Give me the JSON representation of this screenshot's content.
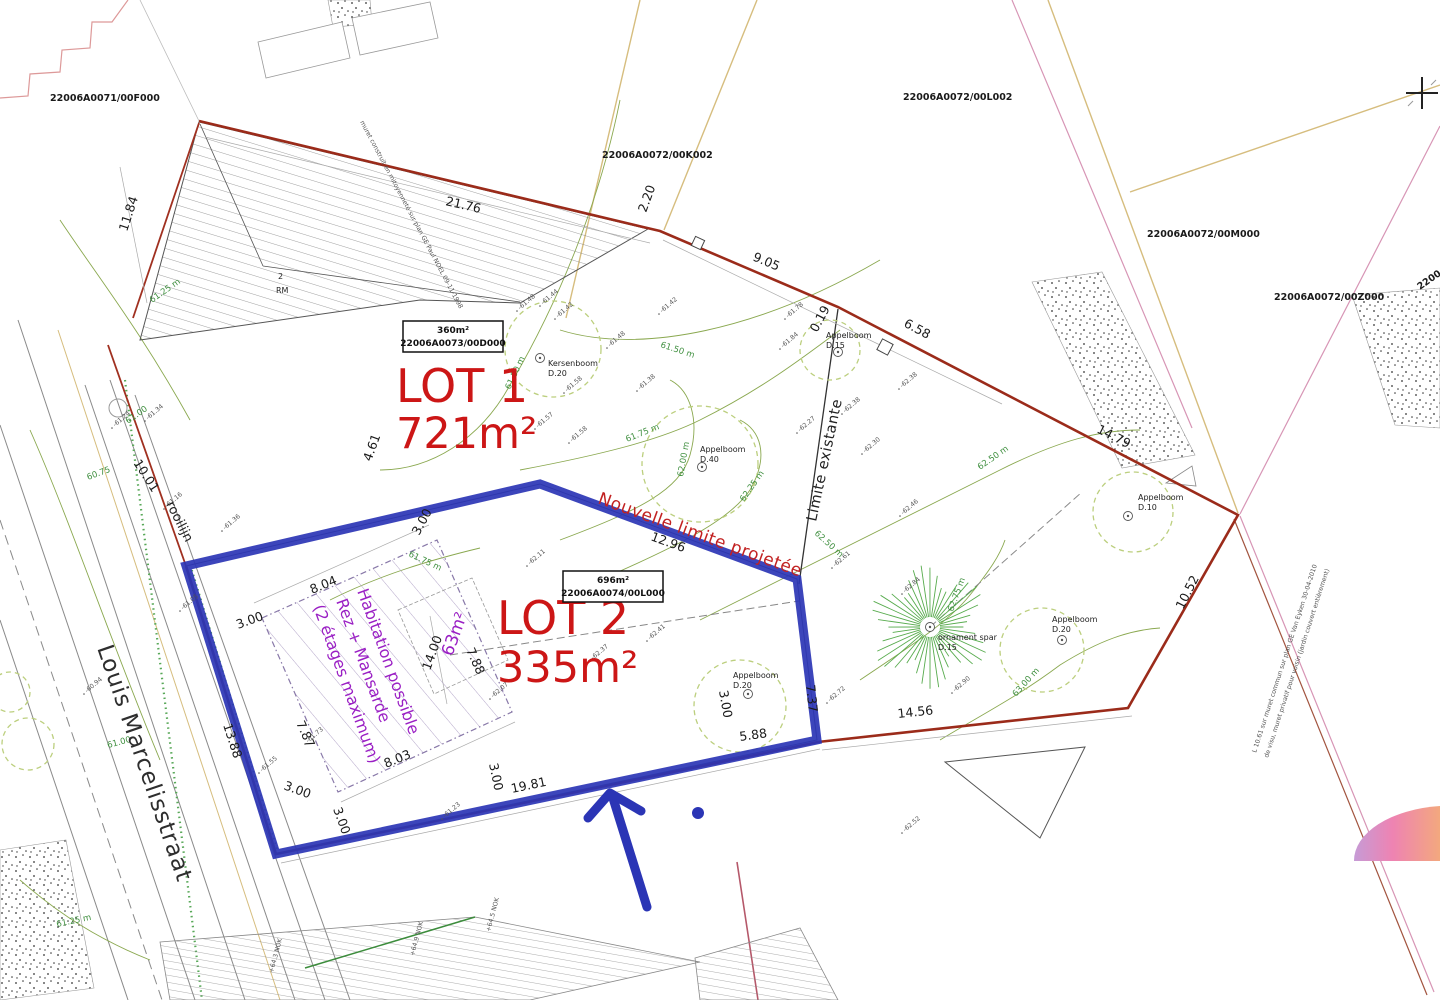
{
  "title": "Cadastral division plan - Louis Marcelisstraat",
  "colors": {
    "lot_outline_blue": "#2b35b5",
    "boundary_red": "#9b2b1a",
    "lot_text_red": "#cc1616",
    "habitation_purple": "#9a1fc4",
    "contour_green": "#3f8f3f",
    "crown_green": "#bccf7e",
    "spar_green": "#57ab4d",
    "cadastral_beige": "#d6bd7e",
    "cadastral_pink": "#d795b5",
    "street_grey": "#8a8a8a",
    "dome_gradient": [
      "#c69bd6",
      "#ee83b2",
      "#f3a87e"
    ]
  },
  "parcel_labels": [
    {
      "t": "22006A0071/00F000",
      "x": 50,
      "y": 101,
      "r": 0
    },
    {
      "t": "22006A0072/00K002",
      "x": 602,
      "y": 158,
      "r": 0
    },
    {
      "t": "22006A0072/00L002",
      "x": 903,
      "y": 100,
      "r": 0
    },
    {
      "t": "22006A0072/00M000",
      "x": 1147,
      "y": 237,
      "r": 0
    },
    {
      "t": "22006A0072/00Z000",
      "x": 1274,
      "y": 300,
      "r": 0
    },
    {
      "t": "2200",
      "x": 1420,
      "y": 290,
      "r": -35
    }
  ],
  "lots": [
    {
      "name": "LOT 1",
      "area": "721m²",
      "nx": 396,
      "ny": 402,
      "ax": 396,
      "ay": 448
    },
    {
      "name": "LOT 2",
      "area": "335m²",
      "nx": 497,
      "ny": 634,
      "ax": 497,
      "ay": 682
    }
  ],
  "parcel_boxes": [
    {
      "x": 403,
      "y": 321,
      "w": 100,
      "h": 31,
      "line1": "360m²",
      "line2": "22006A0073/00D000"
    },
    {
      "x": 563,
      "y": 571,
      "w": 100,
      "h": 31,
      "line1": "696m²",
      "line2": "22006A0074/00L000"
    }
  ],
  "measurements": [
    {
      "t": "21.76",
      "x": 445,
      "y": 205,
      "r": 13
    },
    {
      "t": "2.20",
      "x": 646,
      "y": 213,
      "r": -70
    },
    {
      "t": "9.05",
      "x": 752,
      "y": 260,
      "r": 23
    },
    {
      "t": "6.58",
      "x": 903,
      "y": 326,
      "r": 28
    },
    {
      "t": "0.19",
      "x": 817,
      "y": 333,
      "r": -62
    },
    {
      "t": "11.84",
      "x": 127,
      "y": 232,
      "r": -72
    },
    {
      "t": "14.79",
      "x": 1096,
      "y": 432,
      "r": 27
    },
    {
      "t": "10.52",
      "x": 1183,
      "y": 610,
      "r": -63
    },
    {
      "t": "12.96",
      "x": 650,
      "y": 540,
      "r": 20
    },
    {
      "t": "14.56",
      "x": 898,
      "y": 718,
      "r": -6
    },
    {
      "t": "5.88",
      "x": 740,
      "y": 741,
      "r": -8
    },
    {
      "t": "7.37",
      "x": 806,
      "y": 685,
      "r": 84
    },
    {
      "t": "19.81",
      "x": 512,
      "y": 793,
      "r": -12
    },
    {
      "t": "13.88",
      "x": 223,
      "y": 725,
      "r": 72
    },
    {
      "t": "10.01",
      "x": 133,
      "y": 463,
      "r": 57
    },
    {
      "t": "4.61",
      "x": 371,
      "y": 462,
      "r": -70
    },
    {
      "t": "8.04",
      "x": 312,
      "y": 594,
      "r": -22
    },
    {
      "t": "7.87",
      "x": 296,
      "y": 723,
      "r": 66
    },
    {
      "t": "7.88",
      "x": 466,
      "y": 650,
      "r": 66
    },
    {
      "t": "8.03",
      "x": 386,
      "y": 768,
      "r": -22
    },
    {
      "t": "14.00",
      "x": 430,
      "y": 671,
      "r": -70
    },
    {
      "t": "3.00",
      "x": 419,
      "y": 536,
      "r": -62
    },
    {
      "t": "3.00",
      "x": 238,
      "y": 629,
      "r": -20
    },
    {
      "t": "3.00",
      "x": 283,
      "y": 789,
      "r": 20
    },
    {
      "t": "3.00",
      "x": 333,
      "y": 809,
      "r": 70
    },
    {
      "t": "3.00",
      "x": 489,
      "y": 764,
      "r": 78
    },
    {
      "t": "3.00",
      "x": 719,
      "y": 691,
      "r": 80
    }
  ],
  "contour_labels": [
    {
      "t": "61.50 m",
      "x": 510,
      "y": 390,
      "r": -65
    },
    {
      "t": "61.50 m",
      "x": 660,
      "y": 347,
      "r": 18
    },
    {
      "t": "61.75 m",
      "x": 627,
      "y": 442,
      "r": -22
    },
    {
      "t": "62.00 m",
      "x": 683,
      "y": 477,
      "r": -80
    },
    {
      "t": "62.25 m",
      "x": 744,
      "y": 502,
      "r": -55
    },
    {
      "t": "62.50 m",
      "x": 980,
      "y": 470,
      "r": -35
    },
    {
      "t": "62.50 m",
      "x": 814,
      "y": 534,
      "r": 42
    },
    {
      "t": "62.75 m",
      "x": 953,
      "y": 612,
      "r": -70
    },
    {
      "t": "63.00 m",
      "x": 1016,
      "y": 697,
      "r": -48
    },
    {
      "t": "61.25 m",
      "x": 152,
      "y": 303,
      "r": -35
    },
    {
      "t": "61.00",
      "x": 128,
      "y": 424,
      "r": -35
    },
    {
      "t": "61.00",
      "x": 108,
      "y": 748,
      "r": -15
    },
    {
      "t": "61.25 m",
      "x": 57,
      "y": 927,
      "r": -12
    },
    {
      "t": "60.75",
      "x": 88,
      "y": 480,
      "r": -20
    },
    {
      "t": "61.75 m",
      "x": 408,
      "y": 556,
      "r": 25
    }
  ],
  "spot_elevations": [
    {
      "t": "-61.48",
      "x": 520,
      "y": 310
    },
    {
      "t": "-61.44",
      "x": 543,
      "y": 305
    },
    {
      "t": "-61.42",
      "x": 558,
      "y": 318
    },
    {
      "t": "-61.48",
      "x": 610,
      "y": 347
    },
    {
      "t": "-61.42",
      "x": 662,
      "y": 313
    },
    {
      "t": "-61.58",
      "x": 567,
      "y": 392
    },
    {
      "t": "-61.57",
      "x": 538,
      "y": 428
    },
    {
      "t": "-61.58",
      "x": 572,
      "y": 442
    },
    {
      "t": "-61.38",
      "x": 640,
      "y": 390
    },
    {
      "t": "-61.78",
      "x": 788,
      "y": 318
    },
    {
      "t": "-61.84",
      "x": 783,
      "y": 348
    },
    {
      "t": "-62.38",
      "x": 902,
      "y": 388
    },
    {
      "t": "-62.38",
      "x": 845,
      "y": 413
    },
    {
      "t": "-62.27",
      "x": 800,
      "y": 432
    },
    {
      "t": "-62.30",
      "x": 865,
      "y": 453
    },
    {
      "t": "-62.46",
      "x": 903,
      "y": 515
    },
    {
      "t": "-62.61",
      "x": 835,
      "y": 567
    },
    {
      "t": "-62.84",
      "x": 905,
      "y": 593
    },
    {
      "t": "-62.90",
      "x": 955,
      "y": 692
    },
    {
      "t": "-62.72",
      "x": 830,
      "y": 702
    },
    {
      "t": "-62.11",
      "x": 530,
      "y": 565
    },
    {
      "t": "-62.41",
      "x": 650,
      "y": 640
    },
    {
      "t": "-62.37",
      "x": 593,
      "y": 660
    },
    {
      "t": "-61.16",
      "x": 167,
      "y": 508
    },
    {
      "t": "-61.36",
      "x": 225,
      "y": 530
    },
    {
      "t": "-61.05",
      "x": 183,
      "y": 610
    },
    {
      "t": "-60.94",
      "x": 87,
      "y": 693
    },
    {
      "t": "-61.34",
      "x": 148,
      "y": 420
    },
    {
      "t": "-61.24",
      "x": 115,
      "y": 427
    },
    {
      "t": "-61.55",
      "x": 262,
      "y": 772
    },
    {
      "t": "-61.73",
      "x": 308,
      "y": 743
    },
    {
      "t": "-62.07",
      "x": 493,
      "y": 698
    },
    {
      "t": "-62.52",
      "x": 905,
      "y": 832
    },
    {
      "t": "-61.23",
      "x": 445,
      "y": 818
    }
  ],
  "texts": [
    {
      "t": "Louis Marcelisstraat",
      "x": 97,
      "y": 648,
      "r": 71,
      "cls": "street",
      "name": "street-name"
    },
    {
      "t": "rooilijn",
      "x": 166,
      "y": 504,
      "r": 63,
      "cls": "small-black",
      "name": "rooilijn-label"
    },
    {
      "t": "Limite existante",
      "x": 816,
      "y": 522,
      "r": -78,
      "cls": "limite",
      "name": "existing-limit-label"
    },
    {
      "t": "Nouvelle limite projetée",
      "x": 597,
      "y": 503,
      "r": 20,
      "cls": "nouvelle",
      "name": "new-limit-label"
    },
    {
      "t": "Habitation possible",
      "x": 357,
      "y": 591,
      "r": 70,
      "cls": "purple",
      "name": "habitation-note-line1"
    },
    {
      "t": "Rez + Mansarde",
      "x": 336,
      "y": 601,
      "r": 70,
      "cls": "purple",
      "name": "habitation-note-line2"
    },
    {
      "t": "(2 étages maximum)",
      "x": 313,
      "y": 607,
      "r": 70,
      "cls": "purple",
      "name": "habitation-note-line3"
    },
    {
      "t": "63m²",
      "x": 452,
      "y": 657,
      "r": -70,
      "cls": "purple63",
      "name": "footprint-area-label"
    },
    {
      "t": "RM",
      "x": 276,
      "y": 293,
      "r": 0,
      "cls": "tinyb",
      "name": "building-label-rm"
    },
    {
      "t": "2",
      "x": 278,
      "y": 279,
      "r": 0,
      "cls": "tinyb",
      "name": "building-label-2"
    },
    {
      "t": "muret construit en mitoyenneté sur plan GE Paul NOEL 09-11-1998",
      "x": 360,
      "y": 122,
      "r": 62,
      "cls": "tiny",
      "name": "wall-annotation-left"
    },
    {
      "t": "L 10.61 sur muret commun sur plan GE Van Eyken 30-04-2010",
      "x": 1256,
      "y": 753,
      "r": -72,
      "cls": "tiny",
      "name": "wall-annotation-right-1"
    },
    {
      "t": "de visu, muret privatif pour voisin (jardin couvert entièrement)",
      "x": 1268,
      "y": 758,
      "r": -72,
      "cls": "tiny",
      "name": "wall-annotation-right-2"
    },
    {
      "t": "+64.9 NOK",
      "x": 414,
      "y": 956,
      "r": -75,
      "cls": "tiny",
      "name": "ridge-height-1"
    },
    {
      "t": "+64.5 NOK",
      "x": 490,
      "y": 932,
      "r": -75,
      "cls": "tiny",
      "name": "ridge-height-2"
    },
    {
      "t": "+64.3 NOK",
      "x": 273,
      "y": 973,
      "r": -75,
      "cls": "tiny",
      "name": "ridge-height-3"
    }
  ],
  "trees": [
    {
      "name": "kersenboom-d20",
      "label": "Kersenboom",
      "size": "D.20",
      "dot": [
        540,
        358
      ],
      "crown": [
        553,
        349,
        48
      ],
      "label_xy": [
        548,
        366
      ]
    },
    {
      "name": "appelboom-d40",
      "label": "Appelboom",
      "size": "D.40",
      "dot": [
        702,
        467
      ],
      "crown": [
        700,
        464,
        58
      ],
      "label_xy": [
        700,
        452
      ]
    },
    {
      "name": "appelboom-d15",
      "label": "Appelboom",
      "size": "D.15",
      "dot": [
        838,
        352
      ],
      "crown": [
        830,
        350,
        30
      ],
      "label_xy": [
        826,
        338
      ]
    },
    {
      "name": "appelboom-d10",
      "label": "Appelboom",
      "size": "D.10",
      "dot": [
        1128,
        516
      ],
      "crown": [
        1133,
        512,
        40
      ],
      "label_xy": [
        1138,
        500
      ]
    },
    {
      "name": "appelboom-d20-right",
      "label": "Appelboom",
      "size": "D.20",
      "dot": [
        1062,
        640
      ],
      "crown": [
        1042,
        650,
        42
      ],
      "label_xy": [
        1052,
        622
      ]
    },
    {
      "name": "appelboom-d20-mid",
      "label": "Appelboom",
      "size": "D.20",
      "dot": [
        748,
        694
      ],
      "crown": [
        740,
        706,
        46
      ],
      "label_xy": [
        733,
        678
      ]
    },
    {
      "name": "ornament-spar-d15",
      "label": "ornament spar",
      "size": "D.15",
      "dot": [
        930,
        627
      ],
      "crown": [
        930,
        627,
        52
      ],
      "label_xy": [
        938,
        640
      ],
      "type": "spar"
    }
  ]
}
